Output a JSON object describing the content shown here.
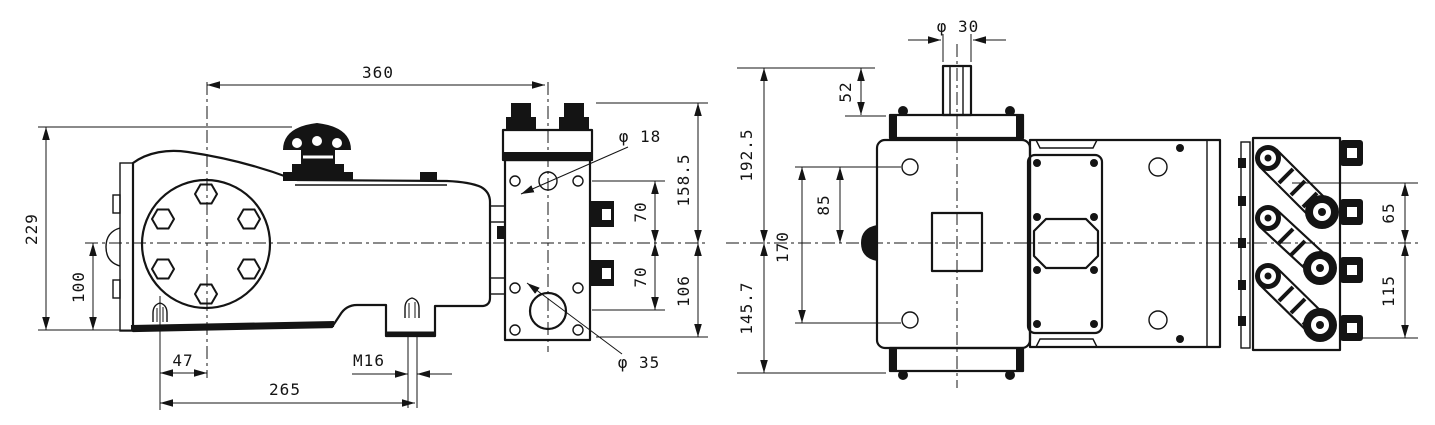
{
  "drawing": {
    "background": "#ffffff",
    "line_color": "#141414",
    "views": {
      "side": {
        "name": "pump-side-view",
        "dims": {
          "length_360": "360",
          "height_229": "229",
          "center_100": "100",
          "stud_47": "47",
          "thread_m16": "M16",
          "span_265": "265",
          "hole_phi18": "φ 18",
          "top_158_5": "158.5",
          "port_70a": "70",
          "port_70b": "70",
          "bottom_106": "106",
          "hole_phi35": "φ 35"
        }
      },
      "top": {
        "name": "pump-top-view",
        "dims": {
          "shaft_phi30": "φ 30",
          "shaft_52": "52",
          "front_192_5": "192.5",
          "rear_145_7": "145.7",
          "hole_85": "85",
          "holes_170": "170",
          "valve_65": "65",
          "valve_115": "115"
        }
      }
    }
  }
}
